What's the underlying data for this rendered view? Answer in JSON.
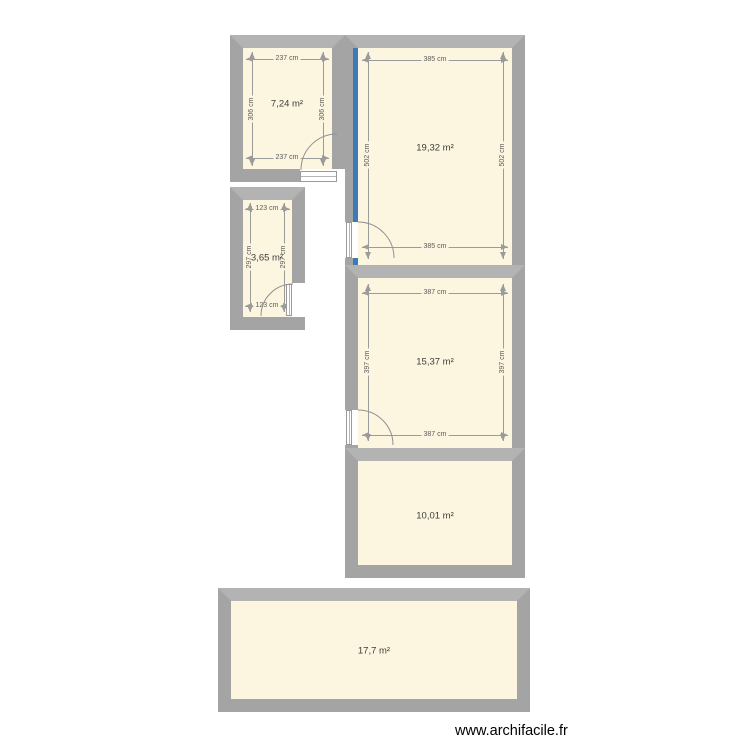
{
  "plan": {
    "colors": {
      "wall": "#a4a4a4",
      "wall_light": "#b3b3b3",
      "floor": "#fcf6e0",
      "hl": "#3d7ab8",
      "dim": "#9b9b9b"
    },
    "rooms": [
      {
        "area": "7,24 m²",
        "w": "237 cm",
        "h": "306 cm"
      },
      {
        "area": "19,32 m²",
        "w": "385 cm",
        "h": "502 cm"
      },
      {
        "area": "3,65 m²",
        "w": "123 cm",
        "h": "297 cm"
      },
      {
        "area": "15,37 m²",
        "w": "387 cm",
        "h": "397 cm"
      },
      {
        "area": "10,01 m²"
      },
      {
        "area": "17,7 m²"
      }
    ]
  },
  "watermark": "www.archifacile.fr"
}
